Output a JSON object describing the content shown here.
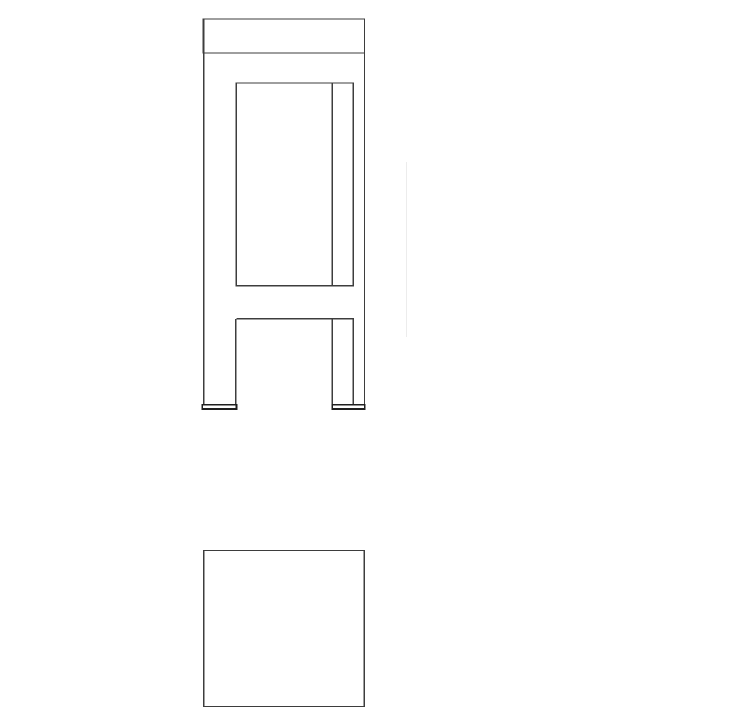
{
  "canvas": {
    "width": 731,
    "height": 728,
    "background": "#ffffff"
  },
  "style": {
    "line_color": "#3d3d3d",
    "heavy_line_color": "#1f1f1f",
    "faint_line_color": "#ececec",
    "line_width": 1.4,
    "heavy_line_width": 1.8,
    "faint_line_width": 1.3
  },
  "drawing": {
    "description": "Two-view CAD line drawing of a chair: side elevation above, plan view square below",
    "views": [
      {
        "name": "chair-side-elevation",
        "shapes": [
          {
            "kind": "rect",
            "name": "backrest-top-rail",
            "x": 203,
            "y": 19,
            "w": 161.5,
            "h": 34,
            "weight": "normal"
          },
          {
            "kind": "line",
            "name": "left-post-edge",
            "x1": 203.7,
            "y1": 19,
            "x2": 203.7,
            "y2": 405.2,
            "weight": "normal"
          },
          {
            "kind": "line",
            "name": "right-post-edge",
            "x1": 364.5,
            "y1": 19,
            "x2": 364.5,
            "y2": 409,
            "weight": "normal"
          },
          {
            "kind": "rect",
            "name": "side-panel",
            "x": 236.3,
            "y": 83,
            "w": 117.1,
            "h": 202.8,
            "weight": "normal"
          },
          {
            "kind": "line",
            "name": "panel-divider",
            "x1": 332.4,
            "y1": 83,
            "x2": 332.4,
            "y2": 285.8,
            "weight": "normal"
          },
          {
            "kind": "line",
            "name": "apron-underside",
            "x1": 236.3,
            "y1": 318.8,
            "x2": 354,
            "y2": 318.8,
            "weight": "normal"
          },
          {
            "kind": "line",
            "name": "front-leg-inner-edge",
            "x1": 235.9,
            "y1": 318.8,
            "x2": 235.9,
            "y2": 404.8,
            "weight": "normal"
          },
          {
            "kind": "line",
            "name": "rear-leg-front-edge",
            "x1": 332.4,
            "y1": 318.8,
            "x2": 332.4,
            "y2": 404.8,
            "weight": "normal"
          },
          {
            "kind": "line",
            "name": "rear-leg-back-edge",
            "x1": 353.4,
            "y1": 318.8,
            "x2": 353.4,
            "y2": 404.8,
            "weight": "normal"
          },
          {
            "kind": "rect",
            "name": "front-foot-glide",
            "x": 202.3,
            "y": 404.8,
            "w": 34.2,
            "h": 4.2,
            "weight": "heavy"
          },
          {
            "kind": "rect",
            "name": "rear-foot-glide",
            "x": 332.3,
            "y": 404.8,
            "w": 32.5,
            "h": 4.2,
            "weight": "heavy"
          },
          {
            "kind": "line",
            "name": "faint-construction-line",
            "x1": 406.5,
            "y1": 162,
            "x2": 406.5,
            "y2": 337,
            "weight": "faint"
          }
        ]
      },
      {
        "name": "chair-plan-view",
        "shapes": [
          {
            "kind": "rect",
            "name": "seat-plan-outline",
            "x": 203.6,
            "y": 550.5,
            "w": 160.8,
            "h": 156,
            "weight": "normal"
          }
        ]
      }
    ]
  }
}
